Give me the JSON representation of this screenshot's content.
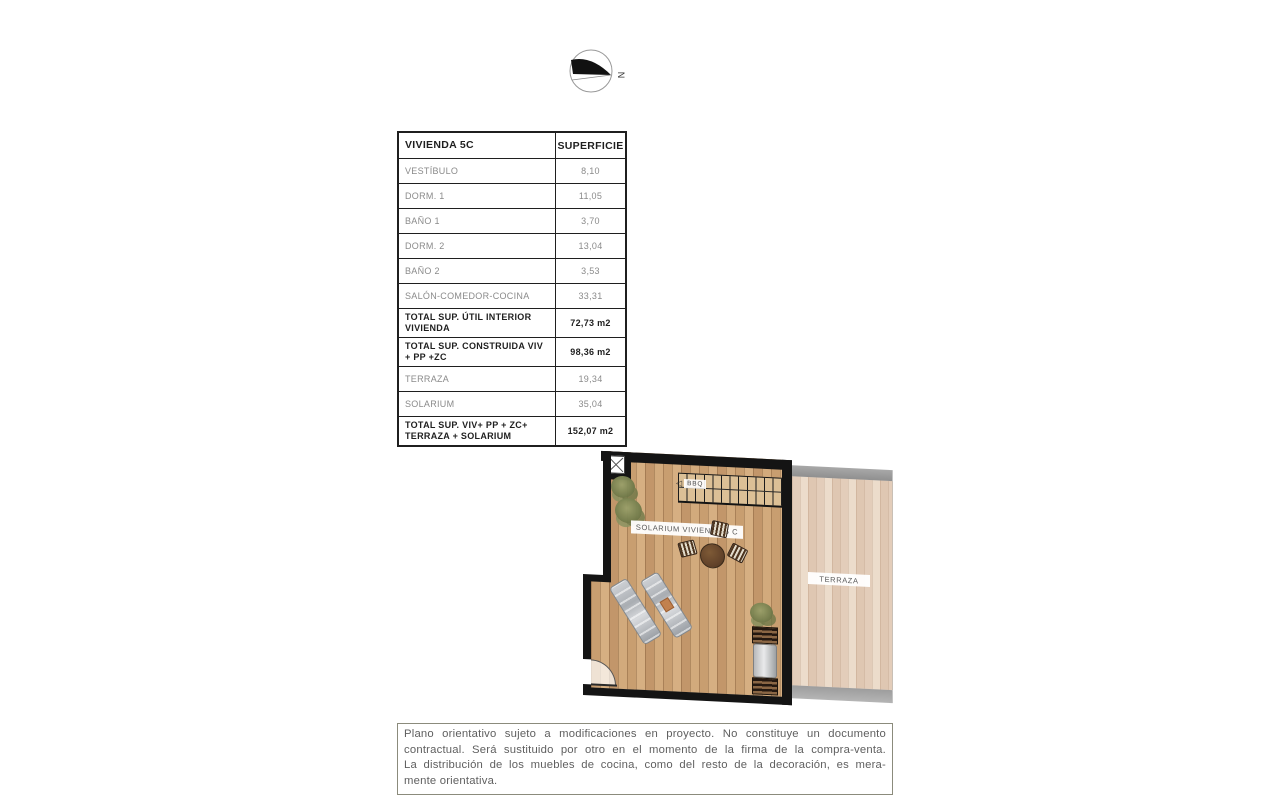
{
  "compass": {
    "north_label": "N"
  },
  "area_table": {
    "header": {
      "col1": "VIVIENDA 5C",
      "col2": "SUPERFICIE"
    },
    "rows": [
      {
        "label": "VESTÍBULO",
        "value": "8,10"
      },
      {
        "label": "DORM. 1",
        "value": "11,05"
      },
      {
        "label": "BAÑO 1",
        "value": "3,70"
      },
      {
        "label": "DORM. 2",
        "value": "13,04"
      },
      {
        "label": "BAÑO 2",
        "value": "3,53"
      },
      {
        "label": "SALÓN-COMEDOR-COCINA",
        "value": "33,31"
      },
      {
        "label": "TOTAL SUP. ÚTIL INTERIOR VIVIENDA",
        "value": "72,73 m2"
      },
      {
        "label": "TOTAL SUP. CONSTRUIDA VIV + PP +ZC",
        "value": "98,36 m2"
      },
      {
        "label": "TERRAZA",
        "value": "19,34"
      },
      {
        "label": "SOLARIUM",
        "value": "35,04"
      },
      {
        "label": "TOTAL SUP. VIV+ PP + ZC+ TERRAZA + SOLARIUM",
        "value": "152,07 m2"
      }
    ]
  },
  "floor_plan": {
    "solarium_label": "SOLARIUM VIVIENDA 5 C",
    "terraza_label": "TERRAZA",
    "bbq_label": "BBQ",
    "stairs_arrow": "◁"
  },
  "disclaimer": {
    "lines": [
      "Plano orientativo sujeto a modificaciones en proyecto. No constituye un documento",
      "contractual. Será sustituido por otro en el momento de la firma de la compra-venta.",
      "La distribución de los muebles de cocina, como del resto de la decoración, es mera-",
      "mente orientativa."
    ]
  },
  "colors": {
    "wall": "#141414",
    "solarium_wood": "#cfa87e",
    "terraza_wood": "#e6d3c1",
    "gray_band": "#9d9d9d",
    "table_text_gray": "#8a8a8a",
    "text_black": "#1f1f1f",
    "disclaimer_text": "#5f5f5f",
    "disclaimer_border": "#8b8b7c"
  }
}
